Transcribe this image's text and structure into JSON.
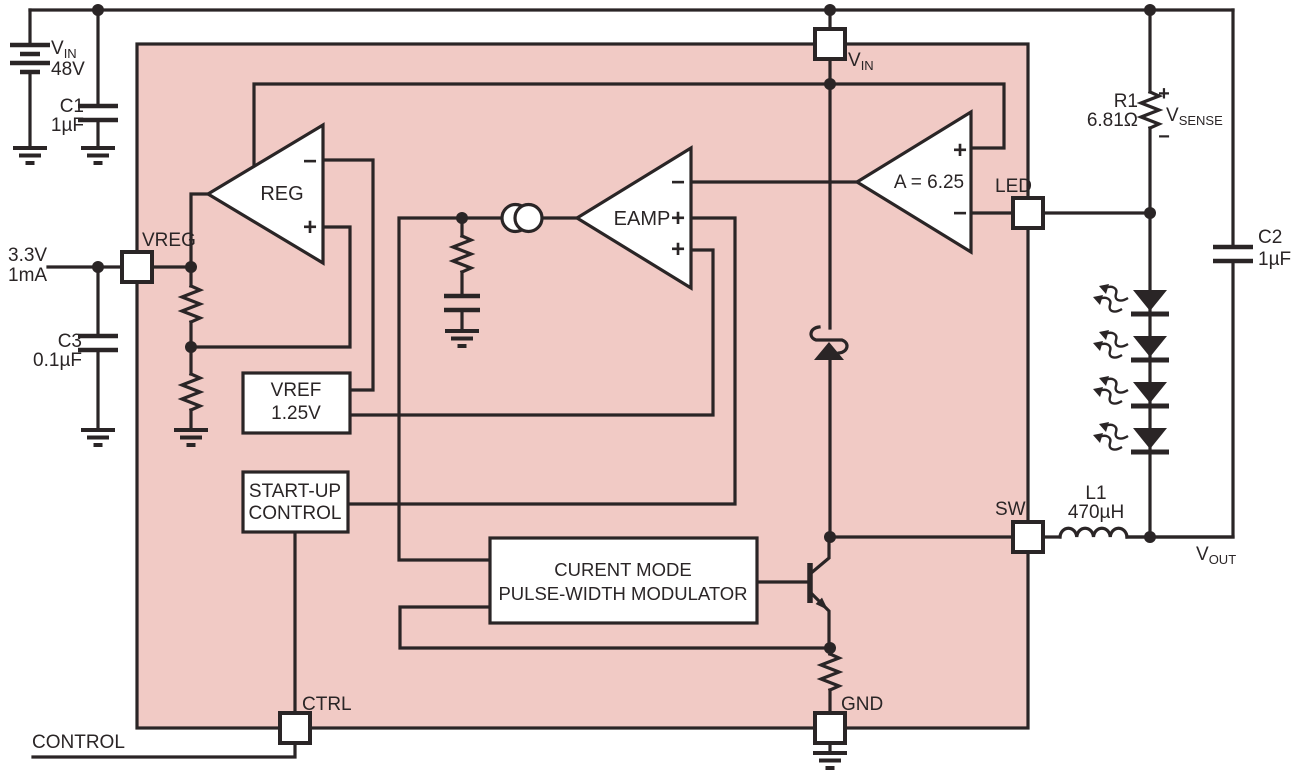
{
  "colors": {
    "ink": "#2a2526",
    "chip_fill": "#f1cac5",
    "component_fill": "#ffffff"
  },
  "external": {
    "supply": {
      "name_main": "V",
      "name_sub": "IN",
      "value": "48V"
    },
    "c1": {
      "name": "C1",
      "value": "1µF"
    },
    "vreg_rail": {
      "line1": "3.3V",
      "line2": "1mA"
    },
    "c3": {
      "name": "C3",
      "value": "0.1µF"
    },
    "control_net": "CONTROL",
    "r1": {
      "name": "R1",
      "value": "6.81Ω",
      "plus": "+",
      "minus": "−",
      "sense_main": "V",
      "sense_sub": "SENSE"
    },
    "c2": {
      "name": "C2",
      "value": "1µF"
    },
    "l1": {
      "name": "L1",
      "value": "470µH"
    },
    "vout": {
      "main": "V",
      "sub": "OUT"
    }
  },
  "pins": {
    "vin_main": "V",
    "vin_sub": "IN",
    "vreg": "VREG",
    "led": "LED",
    "sw": "SW",
    "ctrl": "CTRL",
    "gnd": "GND"
  },
  "blocks": {
    "reg": {
      "label": "REG",
      "minus": "−",
      "plus": "+"
    },
    "eamp": {
      "label": "EAMP",
      "minus": "−",
      "plus_mid": "+",
      "plus_bot": "+"
    },
    "gain": {
      "label": "A = 6.25",
      "plus": "+",
      "minus": "−"
    },
    "vref": {
      "line1": "VREF",
      "line2": "1.25V"
    },
    "startup": {
      "line1": "START-UP",
      "line2": "CONTROL"
    },
    "pwm": {
      "line1": "CURENT MODE",
      "line2": "PULSE-WIDTH MODULATOR"
    }
  }
}
